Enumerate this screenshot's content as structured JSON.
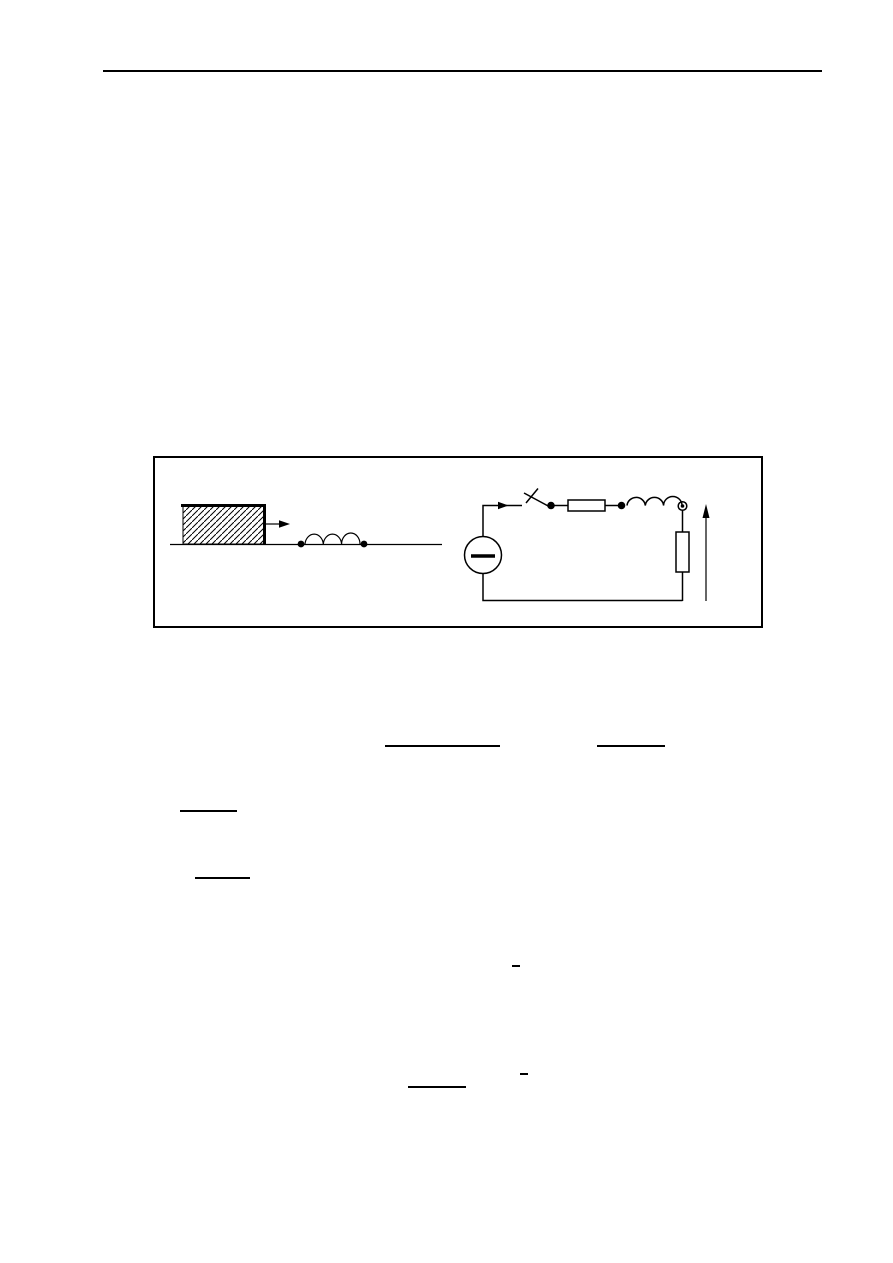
{
  "page": {
    "background_color": "#ffffff",
    "ink_color": "#000000",
    "width_px": 893,
    "height_px": 1263
  },
  "header": {
    "rule": {
      "x": 103,
      "y": 70,
      "width": 719,
      "thickness": 2
    }
  },
  "figure": {
    "box": {
      "x": 153,
      "y": 456,
      "width": 610,
      "height": 172,
      "border_px": 2
    },
    "left_diagram": {
      "components": [
        "hatched-block",
        "force-arrow",
        "ground-line",
        "coil",
        "terminal-dots"
      ]
    },
    "right_diagram": {
      "components": [
        "dc-source",
        "current-arrow",
        "open-switch",
        "series-resistor",
        "series-inductor",
        "load-resistor",
        "voltage-arrow"
      ]
    }
  },
  "equation_marks": [
    {
      "name": "fraction-bar-1",
      "x": 385,
      "y": 745,
      "width": 115,
      "thickness": 2
    },
    {
      "name": "fraction-bar-2",
      "x": 597,
      "y": 745,
      "width": 68,
      "thickness": 2
    },
    {
      "name": "fraction-bar-3",
      "x": 180,
      "y": 810,
      "width": 57,
      "thickness": 2
    },
    {
      "name": "fraction-bar-4",
      "x": 195,
      "y": 877,
      "width": 55,
      "thickness": 2
    },
    {
      "name": "overbar-1",
      "x": 512,
      "y": 965,
      "width": 8,
      "thickness": 2
    },
    {
      "name": "overbar-2",
      "x": 520,
      "y": 1073,
      "width": 8,
      "thickness": 2
    },
    {
      "name": "fraction-bar-5",
      "x": 408,
      "y": 1086,
      "width": 58,
      "thickness": 2
    }
  ]
}
